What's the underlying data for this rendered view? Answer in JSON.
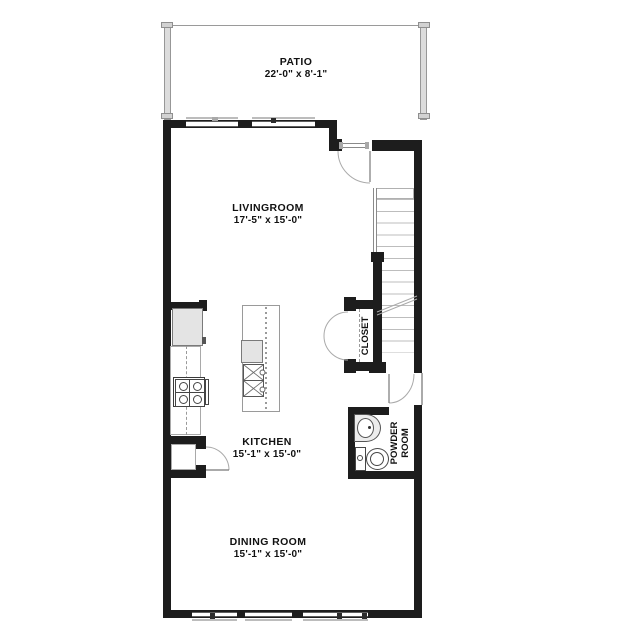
{
  "labels": {
    "patio": {
      "name": "PATIO",
      "dims": "22'-0\" x 8'-1\""
    },
    "living": {
      "name": "LIVINGROOM",
      "dims": "17'-5\" x 15'-0\""
    },
    "kitchen": {
      "name": "KITCHEN",
      "dims": "15'-1\" x 15'-0\""
    },
    "dining": {
      "name": "DINING ROOM",
      "dims": "15'-1\" x 15'-0\""
    },
    "closet": {
      "name": "CLOSET"
    },
    "powder": {
      "line1": "POWDER",
      "line2": "ROOM"
    }
  },
  "colors": {
    "wall": "#1d1d1d",
    "thin_line": "#9a9a9a",
    "patio_wall_fill": "#dcdcdc",
    "appliance_fill": "#e4e4e4",
    "text": "#111111"
  }
}
